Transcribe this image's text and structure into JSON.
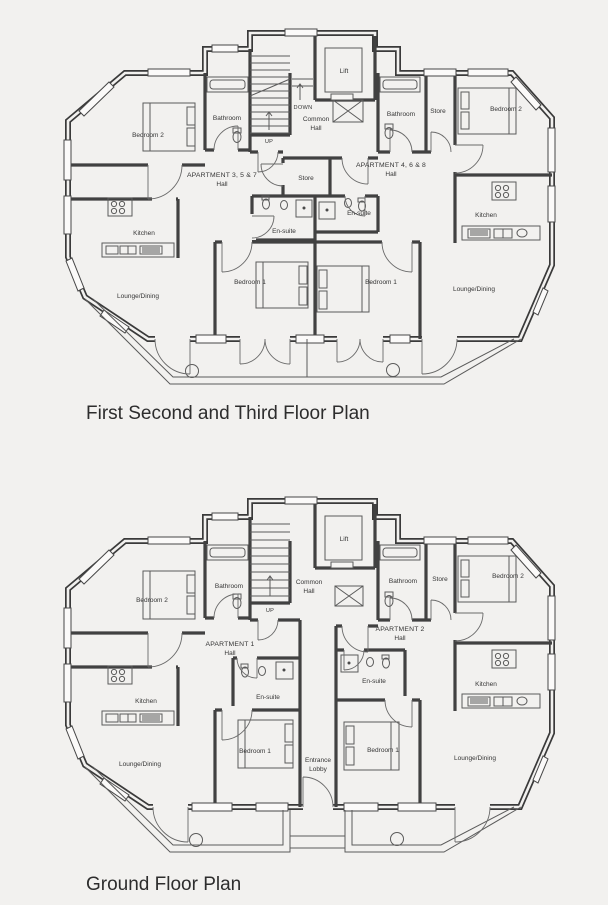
{
  "plans": {
    "upper": {
      "title": "First Second and Third Floor Plan",
      "labels": {
        "bedroom2_left": "Bedroom 2",
        "bathroom_left": "Bathroom",
        "down": "DOWN",
        "up": "UP",
        "common_hall_line1": "Common",
        "common_hall_line2": "Hall",
        "lift": "Lift",
        "bathroom_right": "Bathroom",
        "store_right": "Store",
        "bedroom2_right": "Bedroom 2",
        "apartment_left": "APARTMENT 3, 5 & 7",
        "apartment_left_hall": "Hall",
        "apartment_right": "APARTMENT 4, 6 & 8",
        "apartment_right_hall": "Hall",
        "store_center": "Store",
        "ensuite_left": "En-suite",
        "ensuite_right": "En-suite",
        "kitchen_left": "Kitchen",
        "kitchen_right": "Kitchen",
        "bedroom1_left": "Bedroom 1",
        "bedroom1_right": "Bedroom 1",
        "lounge_left": "Lounge/Dining",
        "lounge_right": "Lounge/Dining"
      }
    },
    "ground": {
      "title": "Ground Floor Plan",
      "labels": {
        "bedroom2_left": "Bedroom 2",
        "bathroom_left": "Bathroom",
        "up": "UP",
        "common_hall_line1": "Common",
        "common_hall_line2": "Hall",
        "lift": "Lift",
        "bathroom_right": "Bathroom",
        "store_right": "Store",
        "bedroom2_right": "Bedroom 2",
        "apartment_left": "APARTMENT 1",
        "apartment_left_hall": "Hall",
        "apartment_right": "APARTMENT 2",
        "apartment_right_hall": "Hall",
        "ensuite_left": "En-suite",
        "ensuite_right": "En-suite",
        "kitchen_left": "Kitchen",
        "kitchen_right": "Kitchen",
        "bedroom1_left": "Bedroom 1",
        "bedroom1_right": "Bedroom 1",
        "lounge_left": "Lounge/Dining",
        "lounge_right": "Lounge/Dining",
        "entrance_line1": "Entrance",
        "entrance_line2": "Lobby"
      }
    }
  },
  "colors": {
    "paper": "#f2f1ef",
    "ink": "#3a3a3a"
  }
}
